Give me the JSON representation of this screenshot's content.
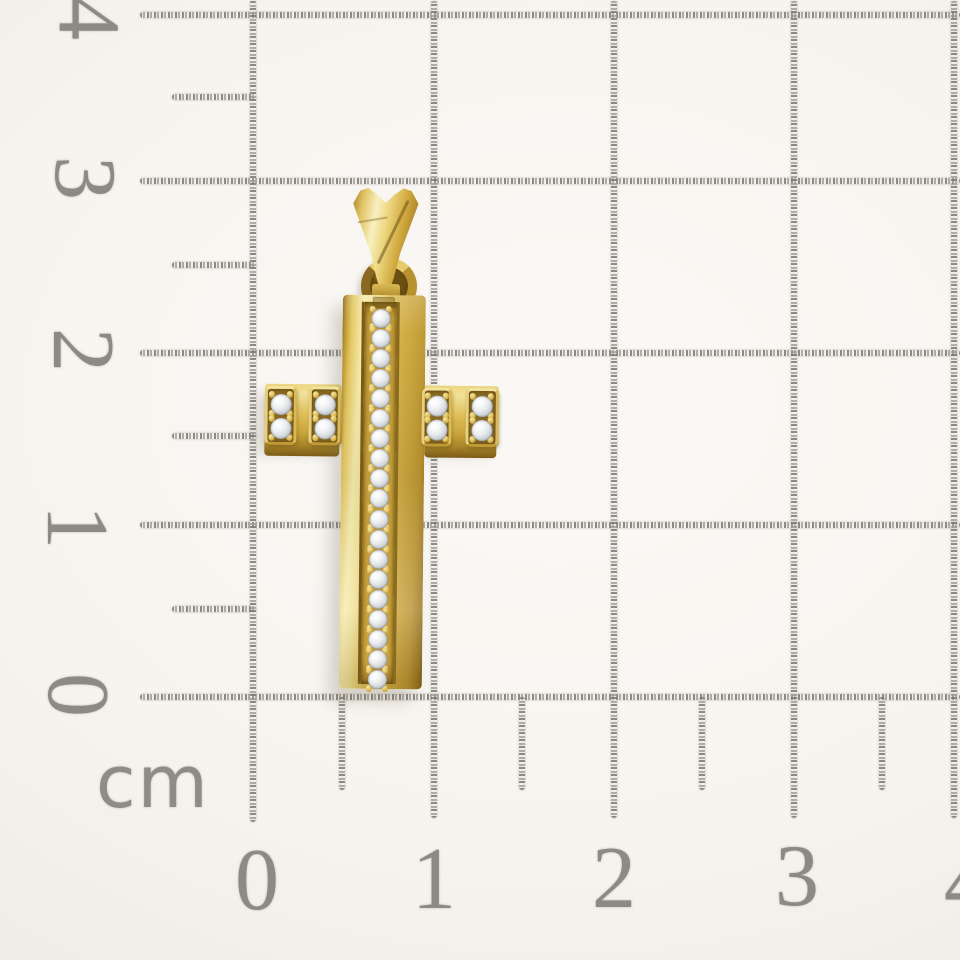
{
  "subject": "yellow-gold-cross-pendant-with-clear-round-stones-on-centimeter-grid-paper",
  "ruler": {
    "unit": "cm",
    "x_labels": [
      "0",
      "1",
      "2",
      "3",
      "4"
    ],
    "y_labels": [
      "4",
      "3",
      "2",
      "1",
      "0"
    ]
  },
  "pendant": {
    "column_stone_count": 19,
    "arm_blocks": [
      {
        "position": "left-outer",
        "stones": 2
      },
      {
        "position": "left-inner",
        "stones": 2
      },
      {
        "position": "right-inner",
        "stones": 2
      },
      {
        "position": "right-outer",
        "stones": 2
      }
    ],
    "colors": {
      "gold_highlight": "#f6ecae",
      "gold_mid": "#d9b84f",
      "gold_shadow": "#8f6c1e",
      "stone": "#f2f4f5",
      "channel": "#c9a33c"
    }
  },
  "grid": {
    "line_color": "#9c9993",
    "label_color": "#8d8a85",
    "paper_color": "#f7f4ef"
  }
}
